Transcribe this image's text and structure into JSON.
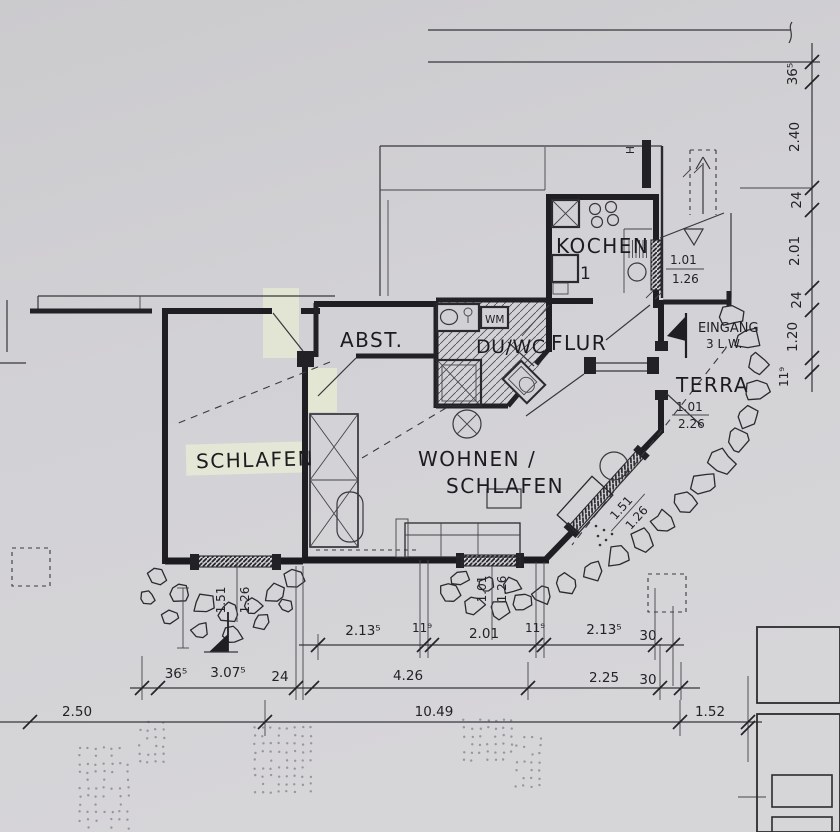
{
  "rooms": {
    "kochen": "KOCHEN",
    "abst": "ABST.",
    "duwc": "DU/WC",
    "wm": "WM",
    "flur": "FLUR",
    "terra": "TERRA",
    "schlafen": "SCHLAFEN",
    "wohnen_line1": "WOHNEN /",
    "wohnen_line2": "SCHLAFEN",
    "eingang": "EINGANG",
    "eingang_width": "3 L.W.",
    "shaft": "H",
    "kitchen_item": "1"
  },
  "dims": {
    "right_chain": [
      "36⁵",
      "2.40",
      "24",
      "2.01",
      "24",
      "1.20",
      "11⁹"
    ],
    "row1": [
      "2.13⁵",
      "11⁹",
      "2.01",
      "11⁹",
      "2.13⁵",
      "30"
    ],
    "row2": [
      "36⁵",
      "3.07⁵",
      "24",
      "4.26",
      "2.25",
      "30"
    ],
    "row3": [
      "2.50",
      "10.49",
      "1.52"
    ],
    "kochen_window": [
      "1.01",
      "1.26"
    ],
    "terra_door": [
      "1.01",
      "2.26"
    ],
    "diag_window": [
      "1.51",
      "1.26"
    ],
    "wohnen_window": [
      "1.01",
      "1.26"
    ],
    "schlafen_window": [
      "1.51",
      "1.26"
    ]
  },
  "colors": {
    "paper": "#d1d0d4",
    "ink": "#202024",
    "highlight": "#e9edd5"
  }
}
